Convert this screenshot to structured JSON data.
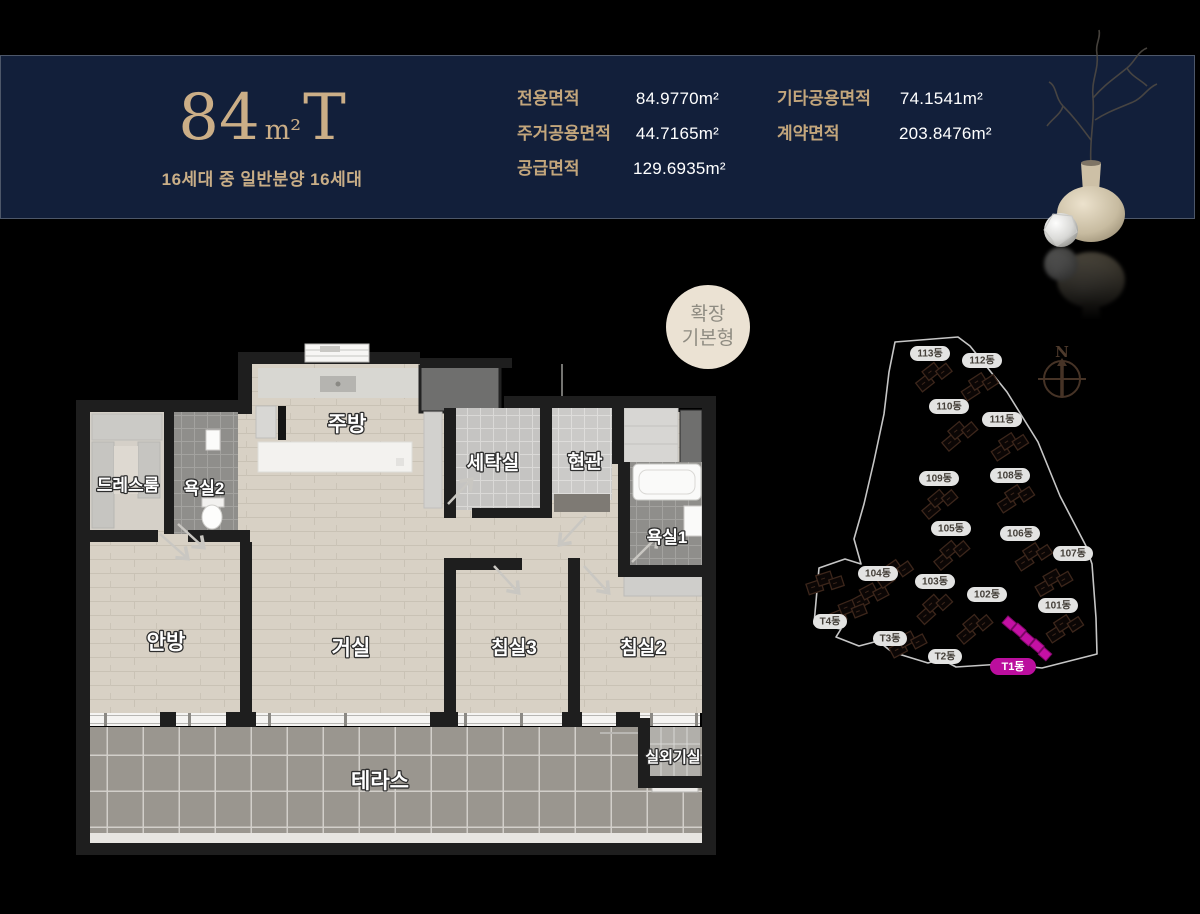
{
  "page": {
    "background": "#000000"
  },
  "header": {
    "title_number": "84",
    "title_unit": "m²",
    "title_suffix": "T",
    "subtitle": "16세대 중 일반분양 16세대",
    "colors": {
      "background": "#121f3a",
      "accent": "#cbae87",
      "value_text": "#ffffff"
    },
    "area_columns": {
      "col1": [
        {
          "label": "전용면적",
          "value": "84.9770m²"
        },
        {
          "label": "주거공용면적",
          "value": "44.7165m²"
        },
        {
          "label": "공급면적",
          "value": "129.6935m²"
        }
      ],
      "col2": [
        {
          "label": "기타공용면적",
          "value": "74.1541m²"
        },
        {
          "label": "계약면적",
          "value": "203.8476m²"
        }
      ]
    }
  },
  "badge": {
    "line1": "확장",
    "line2": "기본형",
    "background": "#ebe2d3",
    "text_color": "#8f8c82"
  },
  "floor_plan": {
    "rooms": [
      {
        "name": "주방"
      },
      {
        "name": "세탁실"
      },
      {
        "name": "현관"
      },
      {
        "name": "드레스룸"
      },
      {
        "name": "욕실2"
      },
      {
        "name": "욕실1"
      },
      {
        "name": "안방"
      },
      {
        "name": "거실"
      },
      {
        "name": "침실3"
      },
      {
        "name": "침실2"
      },
      {
        "name": "실외기실"
      },
      {
        "name": "테라스"
      }
    ]
  },
  "site_plan": {
    "compass_label": "N",
    "highlight_color": "#bb0e9e",
    "buildings": [
      {
        "label": "113동"
      },
      {
        "label": "112동"
      },
      {
        "label": "110동"
      },
      {
        "label": "111동"
      },
      {
        "label": "109동"
      },
      {
        "label": "108동"
      },
      {
        "label": "105동"
      },
      {
        "label": "106동"
      },
      {
        "label": "107동"
      },
      {
        "label": "104동"
      },
      {
        "label": "103동"
      },
      {
        "label": "102동"
      },
      {
        "label": "101동"
      },
      {
        "label": "T4동"
      },
      {
        "label": "T3동"
      },
      {
        "label": "T2동"
      },
      {
        "label": "T1동",
        "highlighted": true
      }
    ]
  }
}
